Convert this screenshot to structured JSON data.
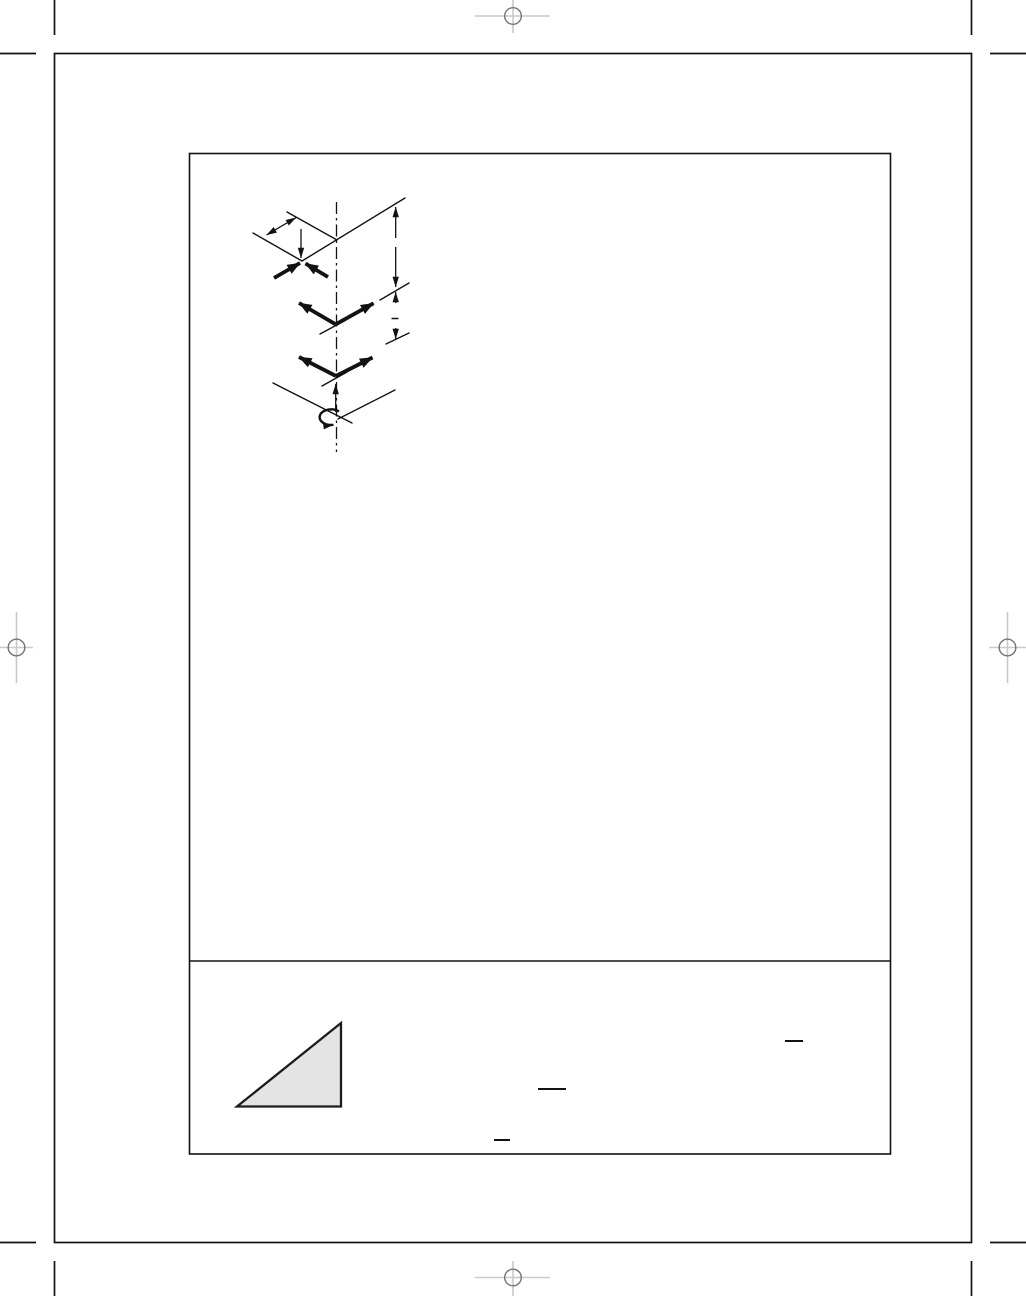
{
  "colors": {
    "paper": "#ffffff",
    "ink": "#121212",
    "registration_crosshair": "#c9c9c9",
    "registration_circle": "#747474",
    "triangle_fill": "#e4e4e4",
    "triangle_stroke": "#1c1c1c"
  },
  "printers_marks": {
    "crop_marks": [
      "top-left",
      "top-right",
      "bottom-left",
      "bottom-right"
    ],
    "registration_targets": [
      "top-center",
      "left-middle",
      "right-middle",
      "bottom-center"
    ]
  },
  "figure_panel": {
    "sections": [
      "diagram-area",
      "footnote-area"
    ],
    "diagram_elements": [
      "vertical-dash-dot-centerline",
      "isometric-reference-lines",
      "offset-dimension-double-arrow",
      "vertical-dimension-column",
      "converging-bold-arrows",
      "middle-v-bold-arrows",
      "lower-v-bold-arrows",
      "upward-pointer-arrow",
      "rotation-arrow"
    ],
    "footnote_elements": [
      "shaded-right-triangle"
    ],
    "text_blanks": {
      "dimension_blank": "—",
      "footnote_blank_1": "—",
      "footnote_blank_2": "—",
      "footnote_blank_3": "—"
    }
  }
}
